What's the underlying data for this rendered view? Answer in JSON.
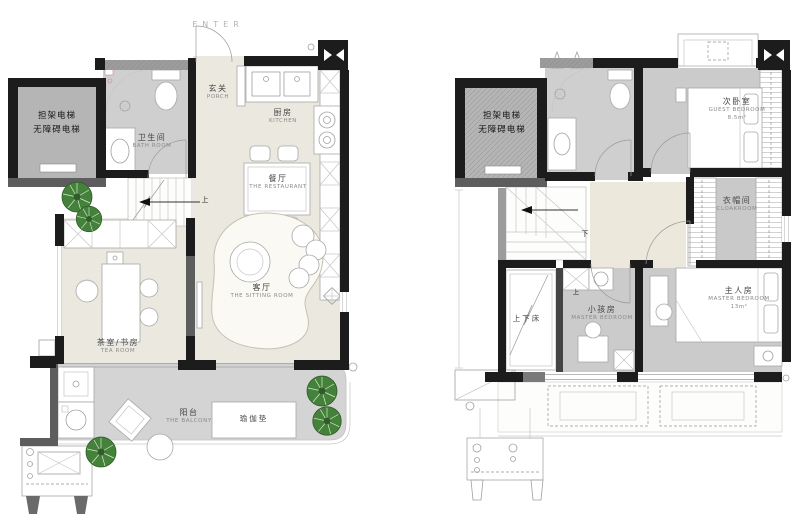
{
  "colors": {
    "wall_black": "#1c1c1c",
    "wall_gray": "#5d5d5d",
    "wall_hatched": "#9c9c9c",
    "floor_beige": "#ebe8df",
    "floor_gray": "#cfcfcf",
    "bedroom_gray": "#cbcbcb",
    "balcony_gray": "#d4d4d4",
    "elevator_gray": "#b5b5b5",
    "hall_beige": "#ece9dc",
    "tree_green": "#44813a"
  },
  "floor1": {
    "enter": "ENTER",
    "elevator": {
      "line1": "担架电梯",
      "line2": "无障碍电梯"
    },
    "stair_direction": "上",
    "rooms": {
      "bath": {
        "zh": "卫生间",
        "en": "BATH ROOM"
      },
      "porch": {
        "zh": "玄关",
        "en": "PORCH"
      },
      "kitchen": {
        "zh": "厨房",
        "en": "KITCHEN"
      },
      "dining": {
        "zh": "餐厅",
        "en": "THE RESTAURANT"
      },
      "sitting": {
        "zh": "客厅",
        "en": "THE SITTING ROOM"
      },
      "tea": {
        "zh": "茶室/书房",
        "en": "TEA ROOM"
      },
      "balcony": {
        "zh": "阳台",
        "en": "THE BALCONY"
      }
    },
    "items": {
      "yoga_mat": "瑜伽垫"
    }
  },
  "floor2": {
    "elevator": {
      "line1": "担架电梯",
      "line2": "无障碍电梯"
    },
    "stair_direction": "下",
    "up_marker": "上",
    "rooms": {
      "guest": {
        "zh": "次卧室",
        "en": "GUEST BEDROOM",
        "area": "8.5m²"
      },
      "cloak": {
        "zh": "衣帽间",
        "en": "CLOAKROOM"
      },
      "master": {
        "zh": "主人房",
        "en": "MASTER BEDROOM",
        "area": "13m²"
      },
      "kids": {
        "zh": "小孩房",
        "en": "MASTER BEDROOM"
      },
      "bunk": {
        "zh": "上下床"
      }
    }
  }
}
